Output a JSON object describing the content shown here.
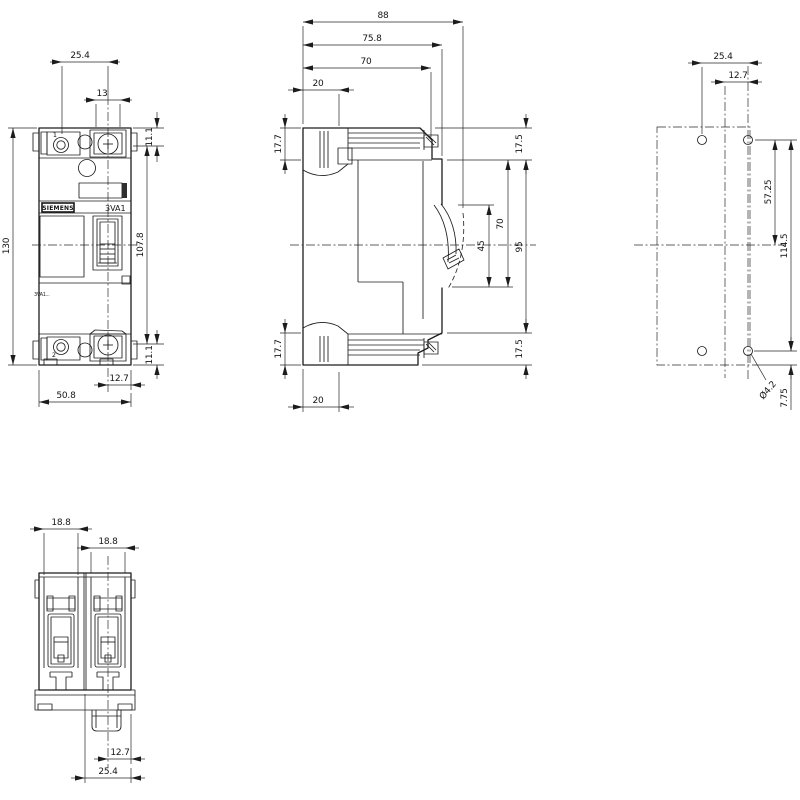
{
  "labels": {
    "brand": "SIEMENS",
    "model": "3VA1",
    "sublabel": "3VA1...",
    "pole_top": "1",
    "pole_bottom": "2"
  },
  "colors": {
    "background": "#ffffff",
    "line": "#1c1c1c"
  },
  "views": {
    "front": {
      "dims": {
        "terminal_pitch": "25.4",
        "terminal_width": "13",
        "terminal_height_top": "11.1",
        "overall_height": "130",
        "mount_hole_distance": "107.8",
        "terminal_height_bottom": "11.1",
        "handle_center_offset": "12.7",
        "overall_width": "50.8"
      }
    },
    "side": {
      "dims": {
        "overall_depth": "88",
        "depth_to_escutcheon": "75.8",
        "depth_to_case": "70",
        "terminal_depth_top": "20",
        "terminal_height_top": "17.7",
        "top_margin": "17.5",
        "handle_travel": "45",
        "handle_window": "70",
        "front_length": "95",
        "terminal_height_bottom": "17.7",
        "bottom_margin": "17.5",
        "terminal_depth_bottom": "20"
      }
    },
    "drilling": {
      "dims": {
        "hole_spacing_horizontal": "25.4",
        "hole_offset_center": "12.7",
        "center_to_hole": "57.25",
        "hole_spacing_vertical": "114.5",
        "hole_diameter": "Ø4.2",
        "hole_edge_offset": "7.75"
      }
    },
    "bottom": {
      "dims": {
        "pole_width_left": "18.8",
        "pole_width_right": "18.8",
        "latch_offset": "12.7",
        "latch_width": "25.4"
      }
    }
  }
}
